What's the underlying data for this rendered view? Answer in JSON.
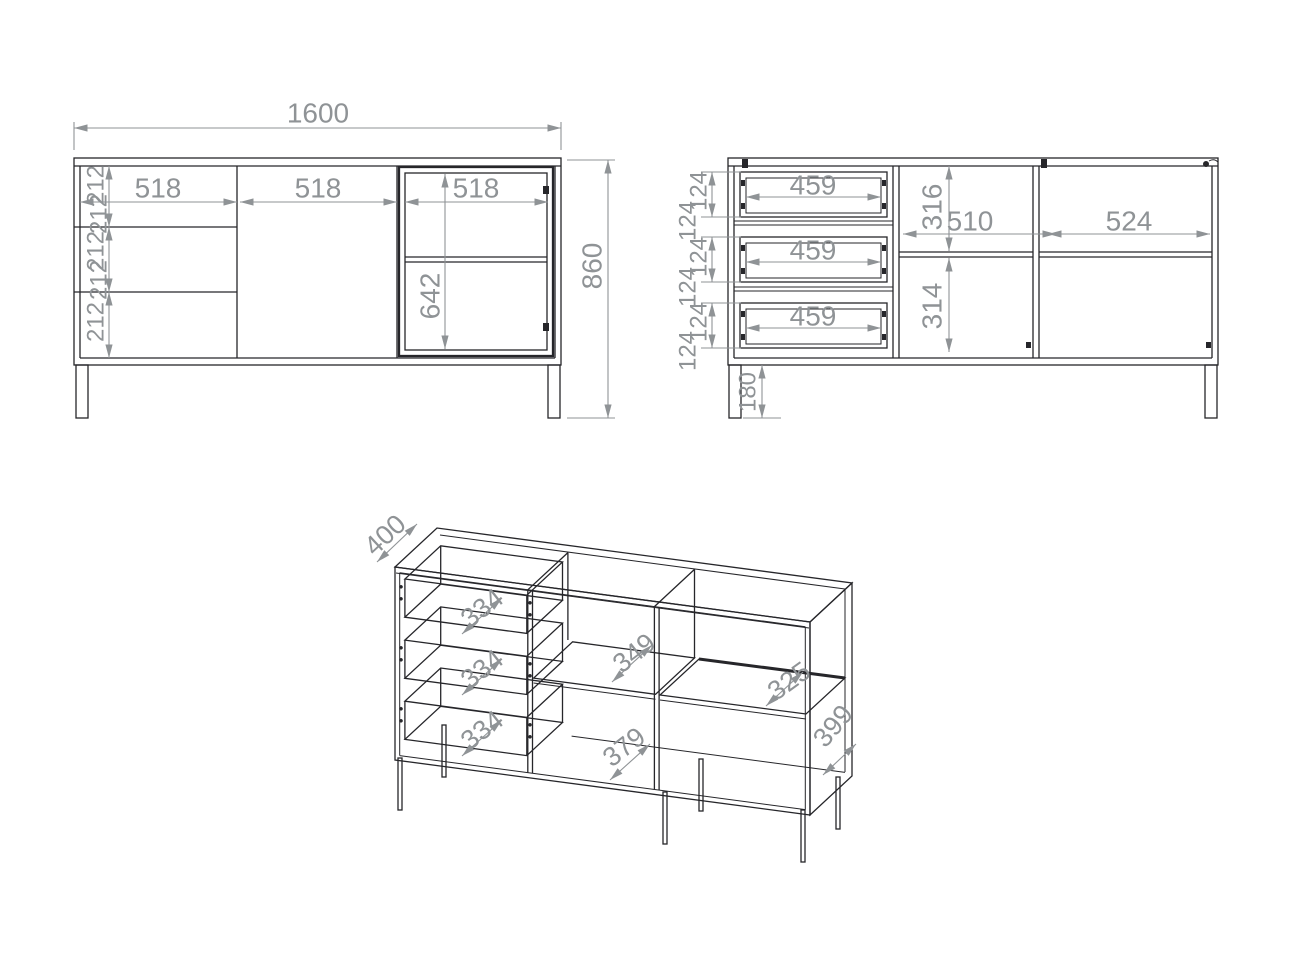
{
  "colors": {
    "line": "#26262a",
    "dimension": "#8f9396",
    "background": "#ffffff"
  },
  "front_view": {
    "width": "1600",
    "height": "860",
    "sections": [
      "518",
      "518",
      "518"
    ],
    "drawer_heights": [
      "212",
      "212",
      "212",
      "212",
      "212"
    ],
    "door_opening_height": "642"
  },
  "interior_view": {
    "drawer_widths": [
      "459",
      "459",
      "459"
    ],
    "drawer_box_heights": [
      "124",
      "124",
      "124",
      "124",
      "124",
      "124"
    ],
    "upper_compartment_height": "316",
    "middle_compartment_width": "510",
    "right_compartment_width": "524",
    "lower_compartment_height": "314",
    "leg_height": "180"
  },
  "perspective_view": {
    "depth": "400",
    "drawer_depths": [
      "334",
      "334",
      "334"
    ],
    "middle_shelf_depth": "349",
    "bottom_shelf_depth": "379",
    "right_shelf_depth": "325",
    "side_depth": "399"
  }
}
